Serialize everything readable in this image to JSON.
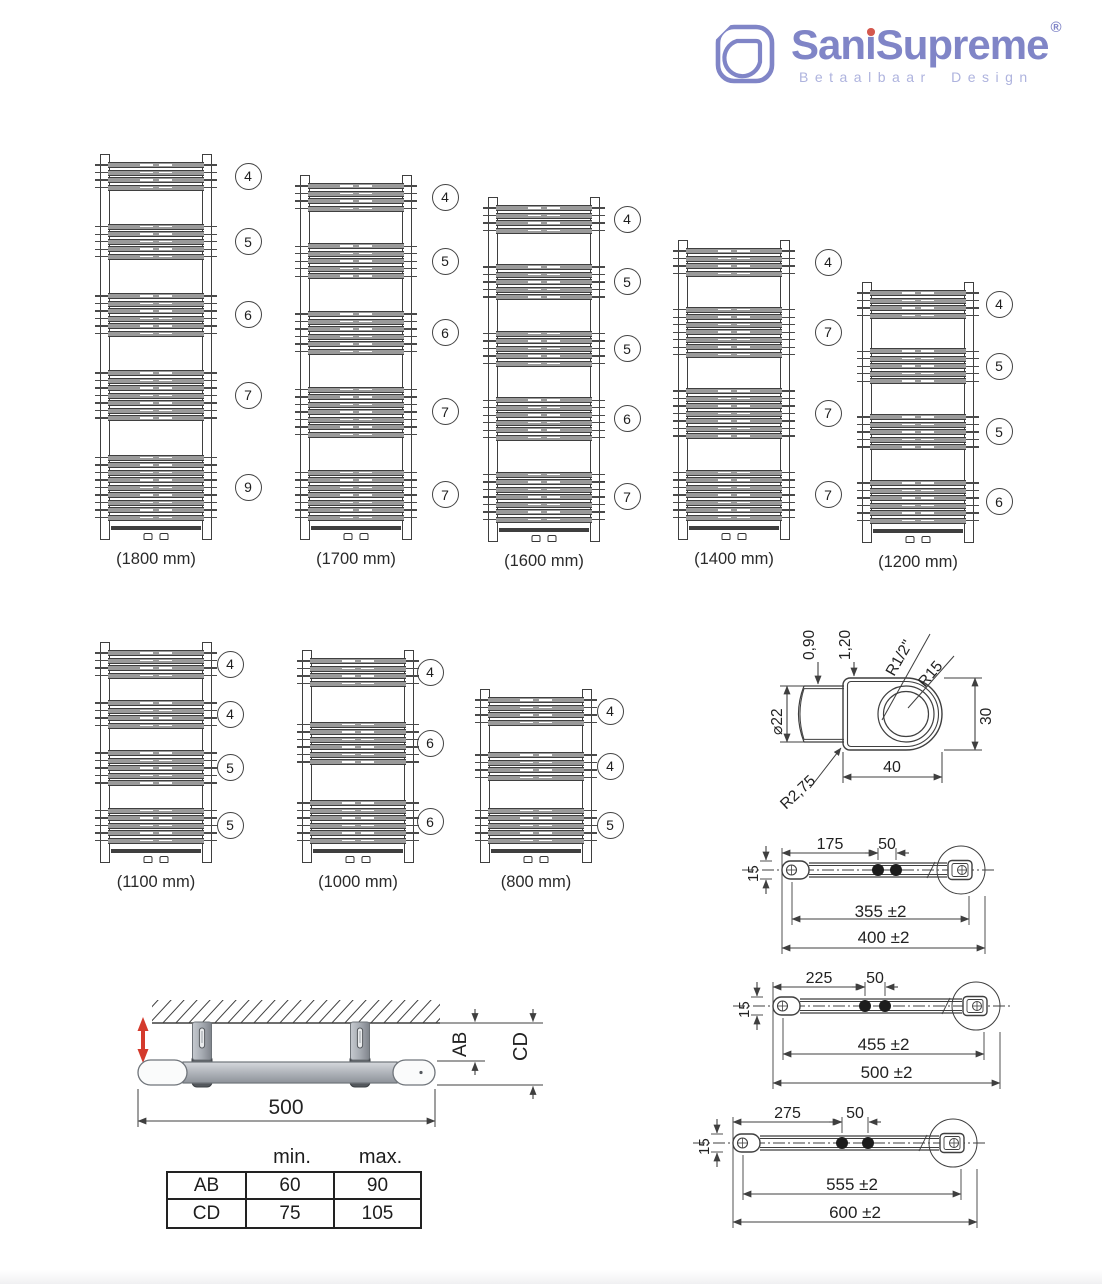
{
  "brand": {
    "name": "SaniSupreme",
    "registered": "®",
    "tagline": "Betaalbaar Design",
    "logo_color": "#8085c7",
    "tagline_color": "#aeb3de",
    "dot_color": "#d4584e"
  },
  "radiators": [
    {
      "label": "(1800 mm)",
      "groups": [
        4,
        5,
        6,
        7,
        9
      ]
    },
    {
      "label": "(1700 mm)",
      "groups": [
        4,
        5,
        6,
        7,
        7
      ]
    },
    {
      "label": "(1600 mm)",
      "groups": [
        4,
        5,
        5,
        6,
        7
      ]
    },
    {
      "label": "(1400 mm)",
      "groups": [
        4,
        7,
        7,
        7
      ]
    },
    {
      "label": "(1200 mm)",
      "groups": [
        4,
        5,
        5,
        6
      ]
    },
    {
      "label": "(1100 mm)",
      "groups": [
        4,
        4,
        5,
        5
      ]
    },
    {
      "label": "(1000 mm)",
      "groups": [
        4,
        6,
        6
      ]
    },
    {
      "label": "(800 mm)",
      "groups": [
        4,
        4,
        5
      ]
    }
  ],
  "profile_detail": {
    "wall_thickness_1": "0,90",
    "wall_thickness_2": "1,20",
    "thread": "R1/2\"",
    "inner_radius": "R15",
    "tube_diameter": "⌀22",
    "height": "30",
    "width": "40",
    "corner_radius": "R2,75"
  },
  "bars": [
    {
      "offset": "175",
      "spacing": "50",
      "end_height": "15",
      "inner": "355 ±2",
      "overall": "400 ±2"
    },
    {
      "offset": "225",
      "spacing": "50",
      "end_height": "15",
      "inner": "455 ±2",
      "overall": "500 ±2"
    },
    {
      "offset": "275",
      "spacing": "50",
      "end_height": "15",
      "inner": "555 ±2",
      "overall": "600 ±2"
    }
  ],
  "mounting": {
    "width": "500",
    "dim_ab": "AB",
    "dim_cd": "CD"
  },
  "table": {
    "headers": [
      "min.",
      "max."
    ],
    "rows": [
      {
        "label": "AB",
        "min": "60",
        "max": "90"
      },
      {
        "label": "CD",
        "min": "75",
        "max": "105"
      }
    ]
  }
}
